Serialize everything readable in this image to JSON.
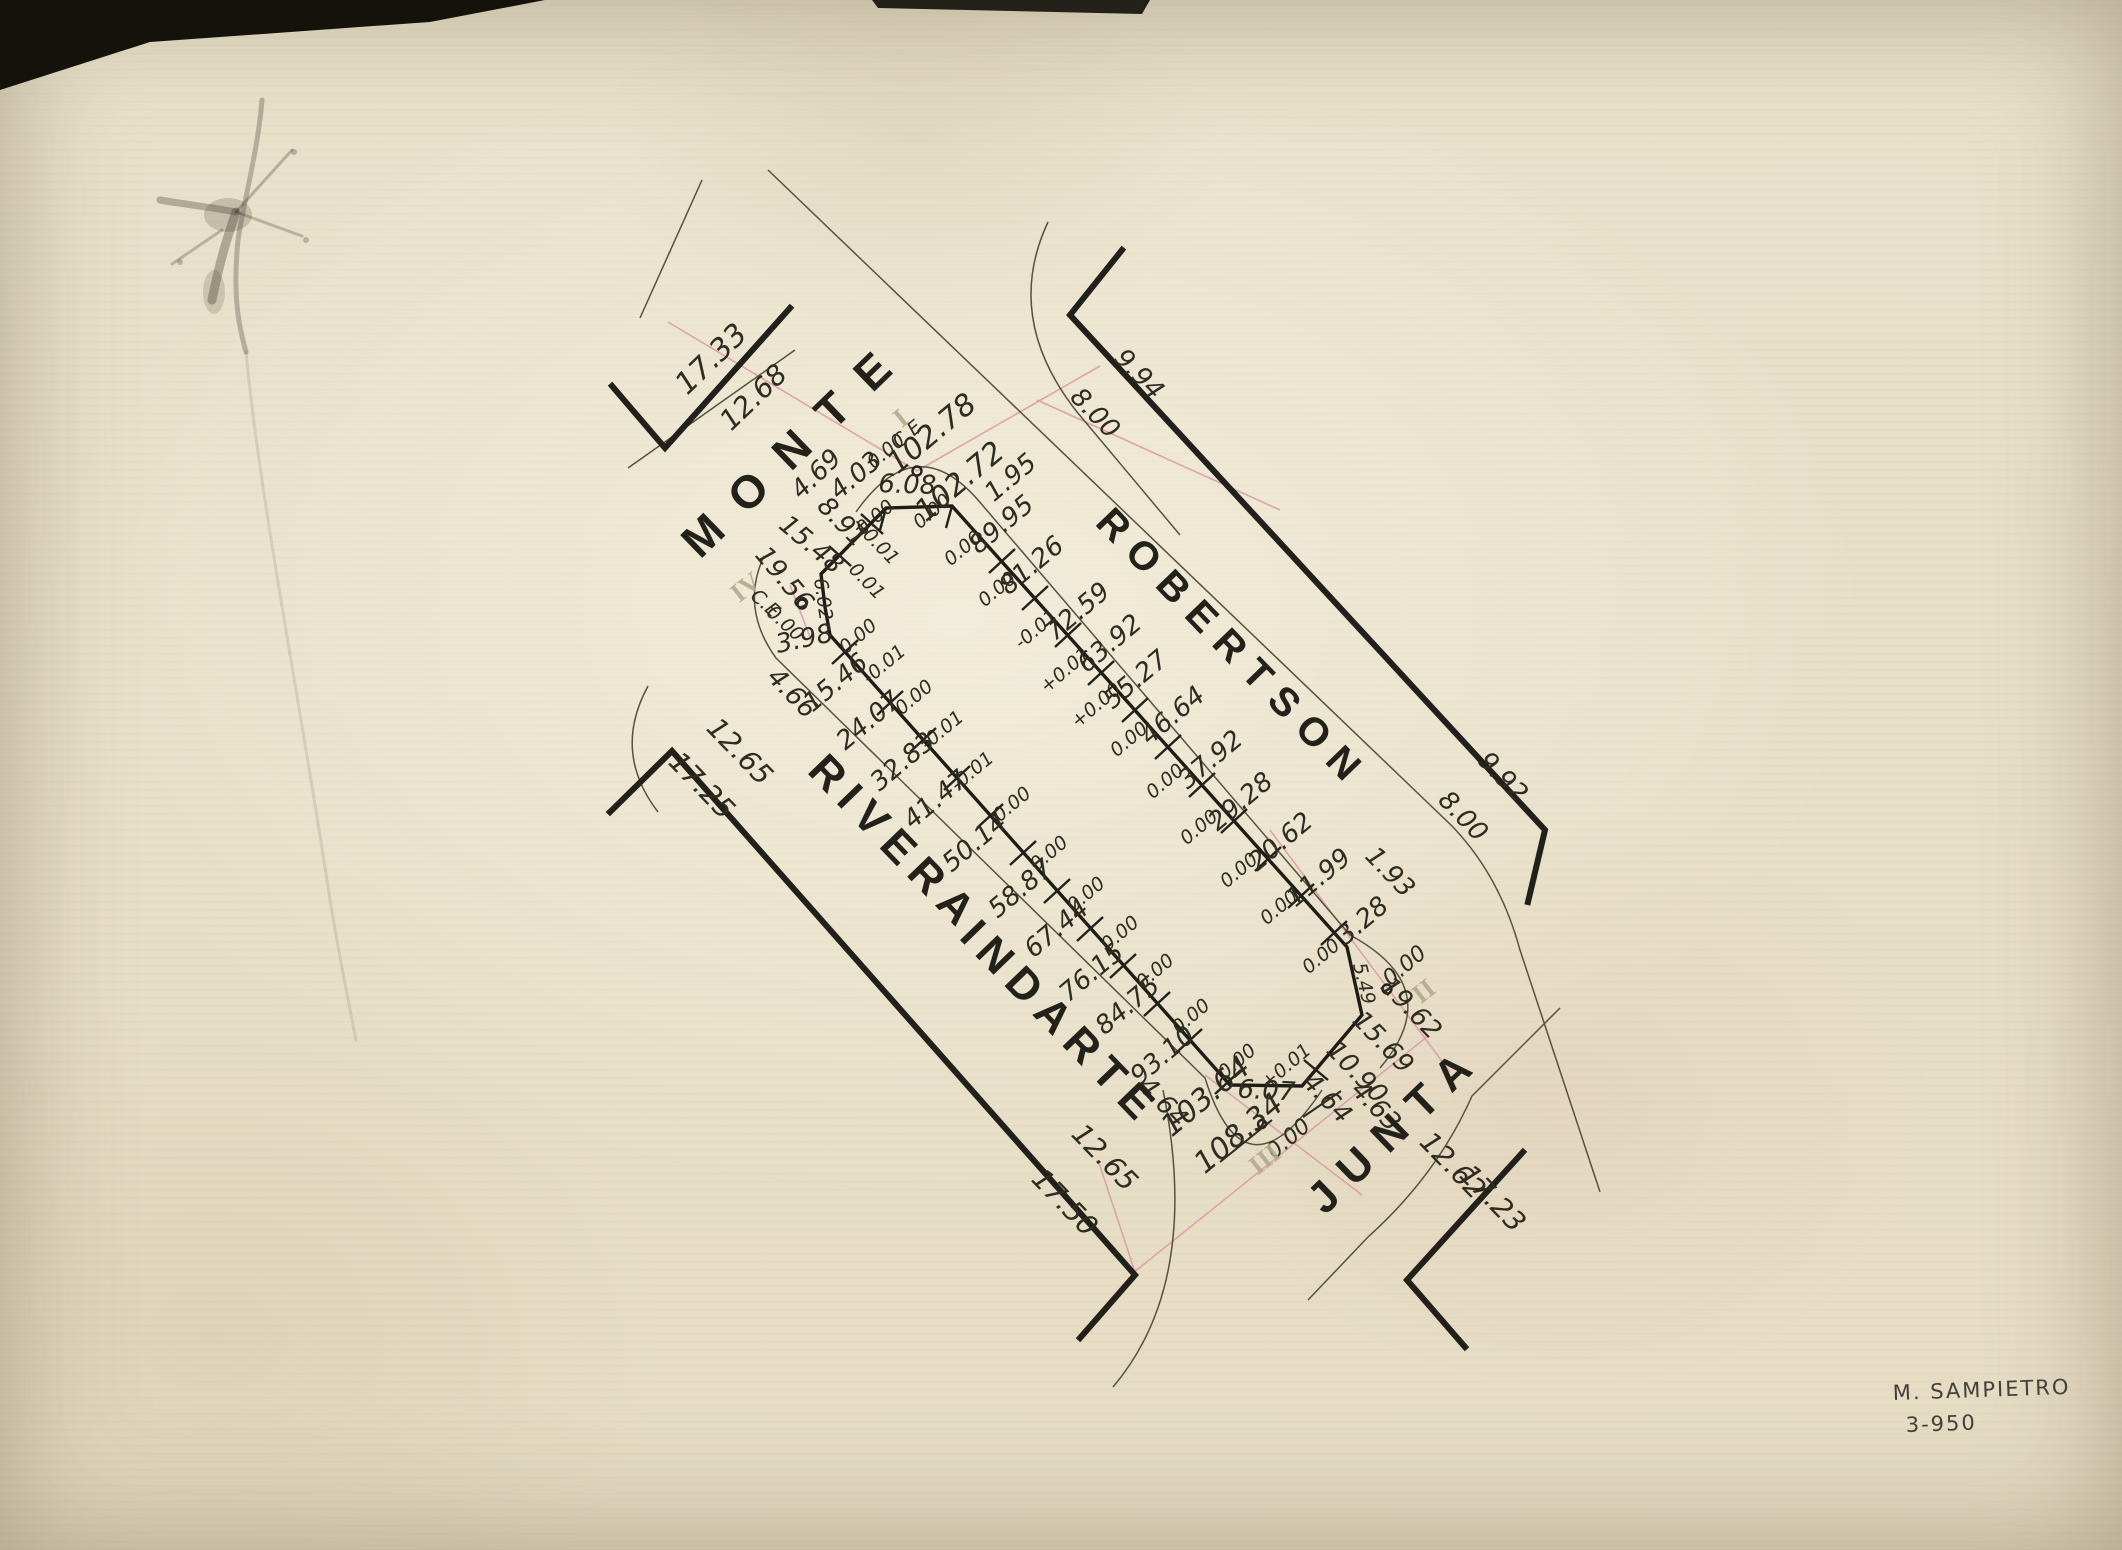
{
  "paper": {
    "background": "#e8e0ca"
  },
  "streets": {
    "monte": "MONTE",
    "robertson": "ROBERTSON",
    "rivera": "RIVERA",
    "indarte": "INDARTE",
    "junta": "JUNTA"
  },
  "corner_markers": {
    "i": "I",
    "ii": "II",
    "iii": "III",
    "iv": "IV"
  },
  "signature": {
    "line1": "M. SAMPIETRO",
    "line2": "3-950"
  },
  "m": {
    "t17_33": "17.33",
    "t12_68": "12.68",
    "t4_69": "4.69",
    "t9_94": "9.94",
    "t8_00a": "8.00",
    "t1_95": "1.95",
    "t9_92": "9.92",
    "t8_00b": "8.00",
    "t1_93": "1.93",
    "t4_66": "4.66",
    "t12_65l": "12.65",
    "t17_25": "17.25",
    "t12_65b": "12.65",
    "t17_50": "17.50",
    "t12_62": "12.62",
    "t17_23": "17.23",
    "ce1": "C.E",
    "ce1v": "0.00",
    "total_ne_out": "102.78",
    "total_ne": "102.72",
    "b4_03": "4.03",
    "b6_08": "6.08",
    "b0a": "0.00",
    "b0b": "0.00",
    "b8_91": "8.91",
    "bp01": "+0.01",
    "bm01": "-0.01",
    "b15_48": "15.48",
    "b19_56": "19.56",
    "ce2": "C.E",
    "ce2v": "0.00",
    "b6_02": "6.02",
    "b3_98": "3.98",
    "b3_98t": "0.00",
    "s89_95": "89.95",
    "v89": "0.00",
    "s81_26": "81.26",
    "v81": "0.00",
    "s72_59": "72.59",
    "v72": "-0.01",
    "s63_92": "63.92",
    "v63": "+0.01",
    "s55_27": "55.27",
    "v55": "+0.00",
    "s46_64": "46.64",
    "v46": "0.00",
    "s37_92": "37.92",
    "v37": "0.00",
    "s29_28": "29.28",
    "v29": "0.00",
    "s20_62": "20.62",
    "v20": "0.00",
    "s11_99": "11.99",
    "v11": "0.00",
    "s3_28": "3.28",
    "v3": "0.00",
    "s15_46": "15.46",
    "w15": "-0.01",
    "s24_07": "24.07",
    "w24": "0.00",
    "s32_83": "32.83",
    "w32": "-0.01",
    "s41_47": "41.47",
    "w41": "-0.01",
    "s50_14": "50.14",
    "w50": "0.00",
    "s58_87": "58.87",
    "w58": "0.00",
    "s67_44": "67.44",
    "w67": "0.00",
    "s76_15": "76.15",
    "w76": "0.00",
    "s84_75": "84.75",
    "w84": "0.00",
    "s93_10": "93.10",
    "w93": "0.00",
    "s103_64": "103.64",
    "w103": "0.00",
    "o5_49": "5.49",
    "ii0": "0.00",
    "s19_62": "19.62",
    "s15_69": "15.69",
    "s10_90": "10.90",
    "t4_63": "4.63",
    "x4_64": "4.64",
    "iip": "+0.01",
    "o6_07": "6.07",
    "total_sw_old": "108.34",
    "iii0": "0.00",
    "t4_64": "4.64"
  }
}
